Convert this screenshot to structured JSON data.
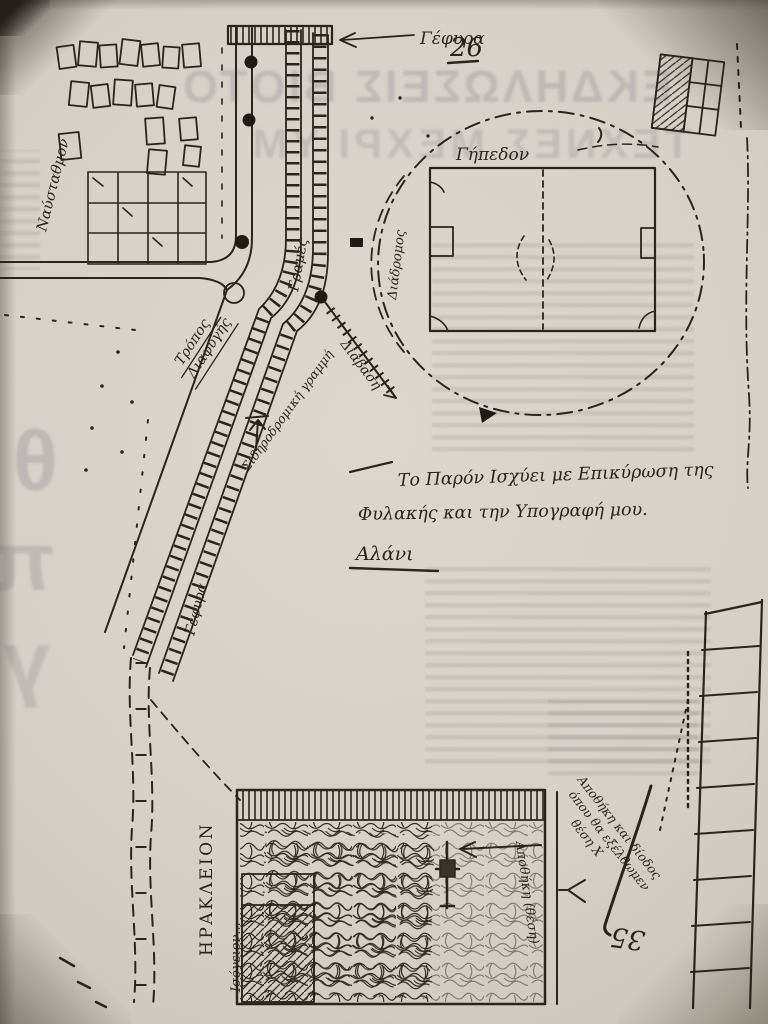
{
  "page": {
    "number_top": "26",
    "number_bottom": "35"
  },
  "labels": {
    "bridge_top": "Γέφυρα",
    "bridge_left": "Γέφυρα",
    "settlement": "Ναύσταθμον",
    "escape_route_line1": "Τρόπος",
    "escape_route_line2": "Διαφυγής",
    "tracks": "Γραμές",
    "crossing": "Διάβαση",
    "railway_line": "Σιδηροδρομική γραμμή",
    "stadium": "Γήπεδον",
    "stadium_track": "Διάδρομος",
    "city": "ΗΡΑΚΛΕΙΟΝ",
    "ground_floor": "Ισόγειον...",
    "storage": "Αποθήκη (θέση)",
    "exit_note_line1": "Αποθήκη και δίοδος",
    "exit_note_line2": "όπου θα εξέλθωμεν",
    "exit_note_line3": "θέση Χ"
  },
  "note": {
    "line1": "Το Παρόν Ισχύει με Επικύρωση της",
    "line2": "Φυλακής και την Υπογραφή μου.",
    "signature": "Αλάνι"
  },
  "bleed_through": {
    "headline1": "ΕΚΔΗΛΩΣΕΙΣ ΒΙΟΤΟ",
    "headline2": "ΤΕΧΝΕΣ ΜΕΧΡΙ ΥΜ",
    "margin_letters": [
      "θ",
      "π",
      "γ"
    ]
  },
  "colors": {
    "ink": "#2b241d",
    "paper": "#d7d2c9",
    "bleed": "#7c7680"
  }
}
